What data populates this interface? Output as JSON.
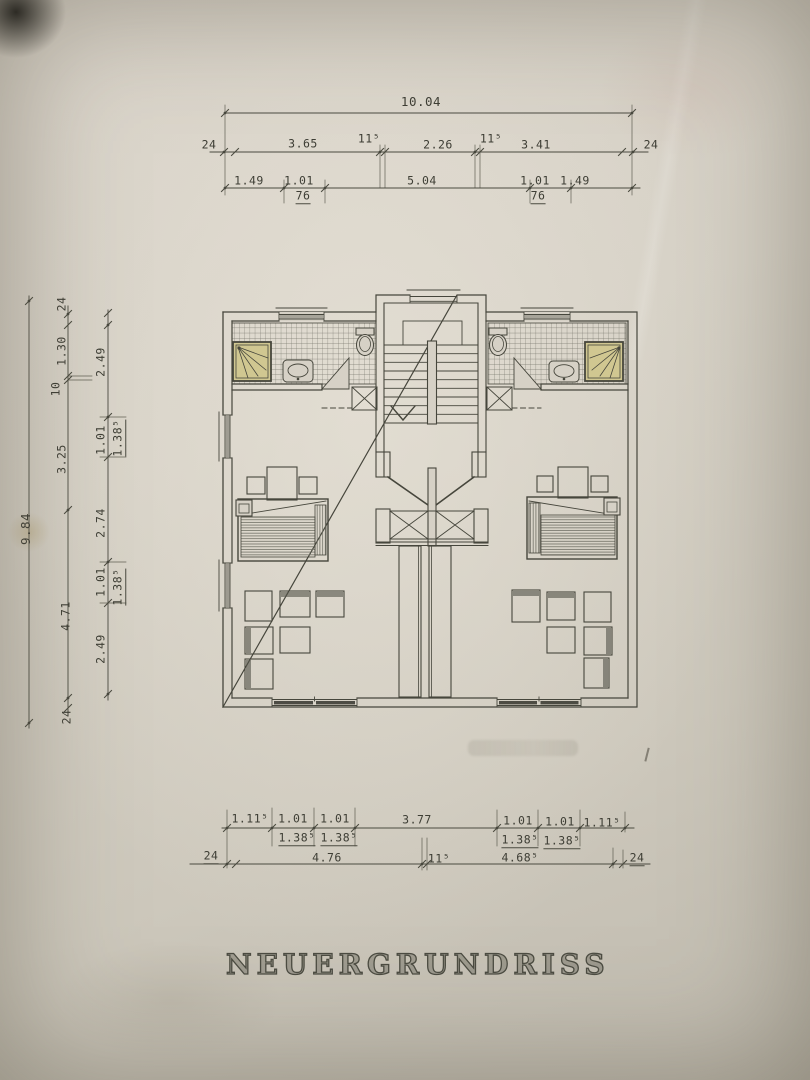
{
  "title": {
    "word1": "NEUER",
    "word2": "GRUNDRISS"
  },
  "dimensions": {
    "top": {
      "overall": "10.04",
      "row2": {
        "wall_l": "24",
        "a": "3.65",
        "b": "11⁵",
        "c": "2.26",
        "d": "11⁵",
        "e": "3.41",
        "wall_r": "24"
      },
      "row3": {
        "a": "1.49",
        "b": "1.01",
        "c": "5.04",
        "d": "1.01",
        "e": "1.49",
        "sub_l": "76",
        "sub_r": "76"
      }
    },
    "left": {
      "overall": "9.84",
      "middle": {
        "wall_t": "24",
        "a": "1.30",
        "b": "10",
        "c": "3.25",
        "d": "4.71",
        "wall_b": "24"
      },
      "inner": {
        "a": "2.49",
        "b": "1.01",
        "sub_t": "1.38⁵",
        "c": "2.74",
        "d": "1.01",
        "sub_b": "1.38⁵",
        "e": "2.49"
      }
    },
    "bottom": {
      "row1": {
        "a": "1.11⁵",
        "b": "1.01",
        "sub1": "1.38⁵",
        "c": "1.01",
        "sub2": "1.38⁵",
        "d": "3.77",
        "e": "1.01",
        "sub3": "1.38⁵",
        "f": "1.01",
        "sub4": "1.38⁵",
        "g": "1.11⁵"
      },
      "row2": {
        "wall_l": "24",
        "a": "4.76",
        "b": "11⁵",
        "c": "4.68⁵",
        "wall_r": "24"
      }
    }
  },
  "colors": {
    "ink": "#46463c",
    "paper": "#d6d1c6",
    "shower": "#d0c791"
  }
}
